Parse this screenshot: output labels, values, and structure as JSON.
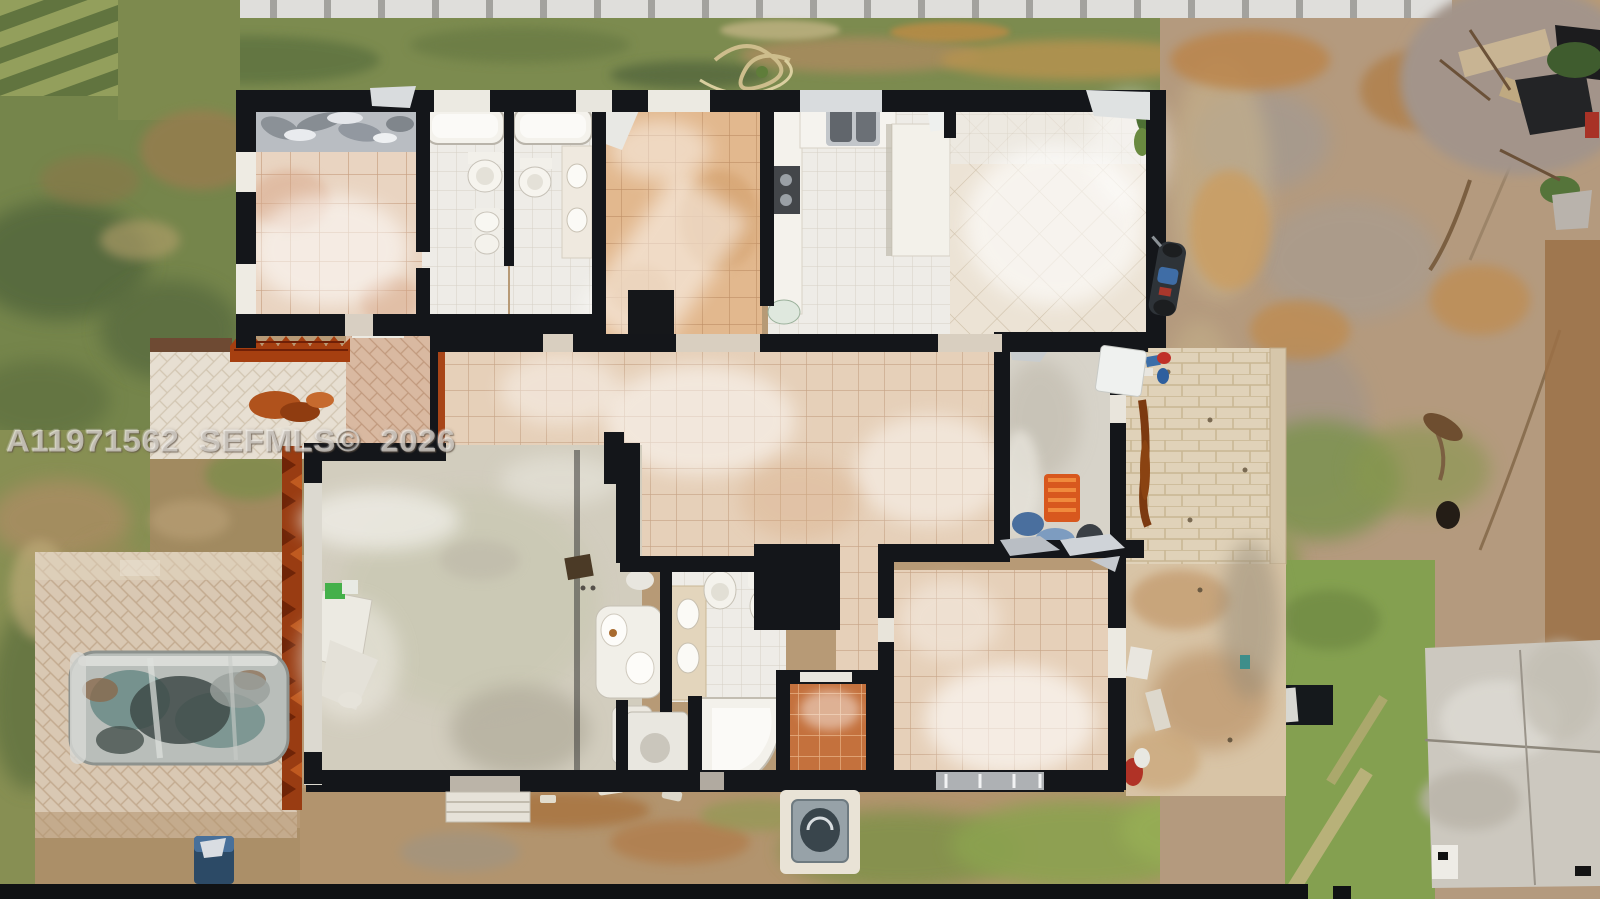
{
  "image": {
    "kind": "aerial-top-down-drone-photo",
    "subject": "Roofless single-story house seen straight from above: exposed tiled rooms with black wall lines, two bathrooms with tubs and toilets, kitchen with counters, master bath with corner tub and double vanity, gray-floored great room, brick-paver driveway with a wrecked car, paver patios, surrounding grass, dirt and storm debris"
  },
  "watermark": {
    "full_text": "A11971562 SEFMLS© 2026"
  },
  "palette": {
    "wall_black": "#14161a",
    "tile_pink_beige": "#e9d4c1",
    "tile_orange": "#e2b88e",
    "bath_white_tile": "#eeece7",
    "great_room_concrete": "#d2cdbe",
    "orange_shower_tile": "#c4713d",
    "driveway_paver": "#d9c8b3",
    "grass_green": "#75854b",
    "bright_grass": "#8aa755",
    "dirt_tan": "#b79a76",
    "rust_debris": "#993c12",
    "car_teal_gray": "#6f8d8a"
  }
}
